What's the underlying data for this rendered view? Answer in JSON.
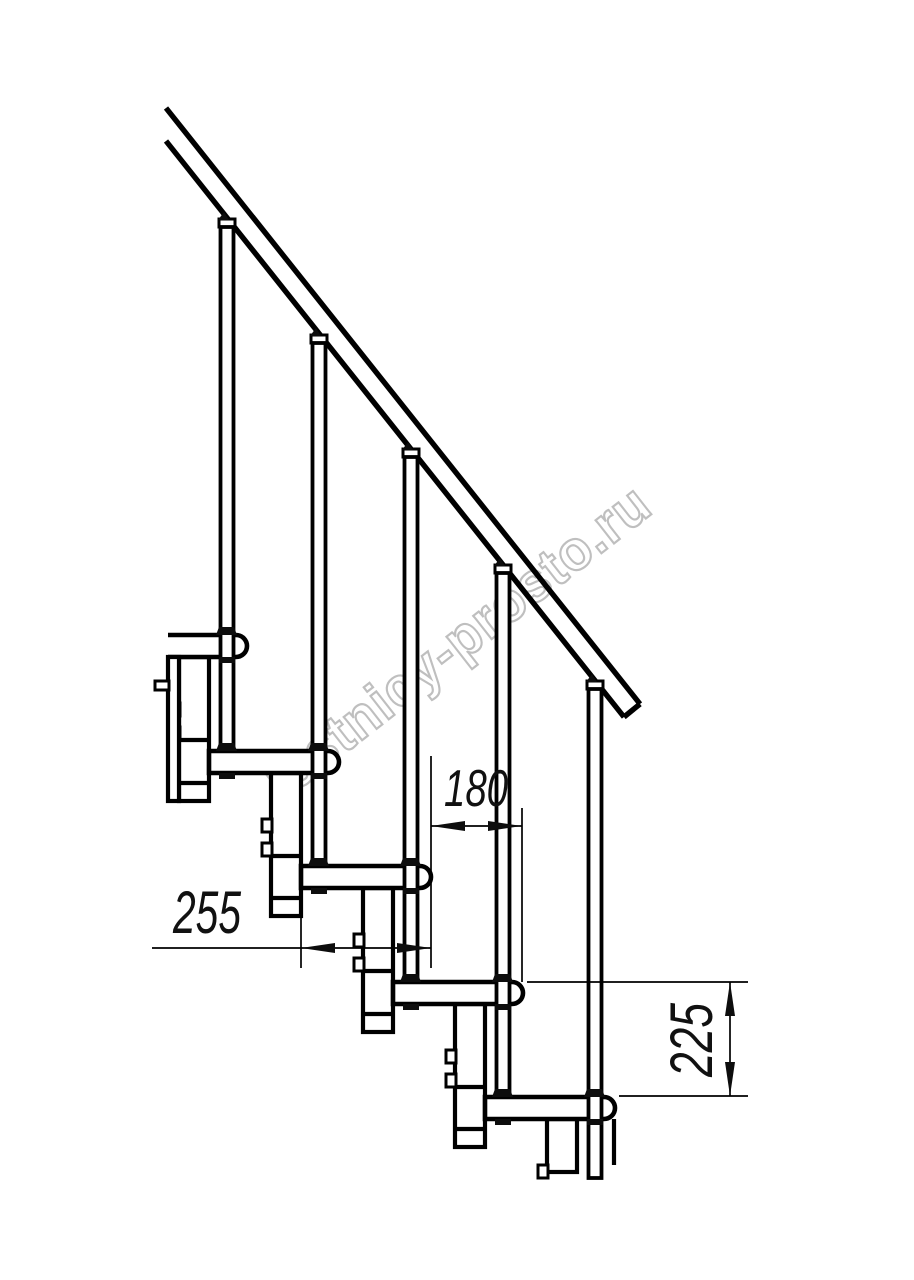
{
  "page": {
    "background": "#ffffff"
  },
  "drawing": {
    "type": "staircase-side-elevation",
    "watermark": "lestnicy-prosto.ru",
    "dimensions": {
      "tread_depth_mm": "255",
      "going_mm": "180",
      "rise_mm": "225"
    },
    "colors": {
      "line": "#000000",
      "watermark": "#bfbfbf",
      "dimension_text": "#111111",
      "background": "#ffffff"
    }
  }
}
